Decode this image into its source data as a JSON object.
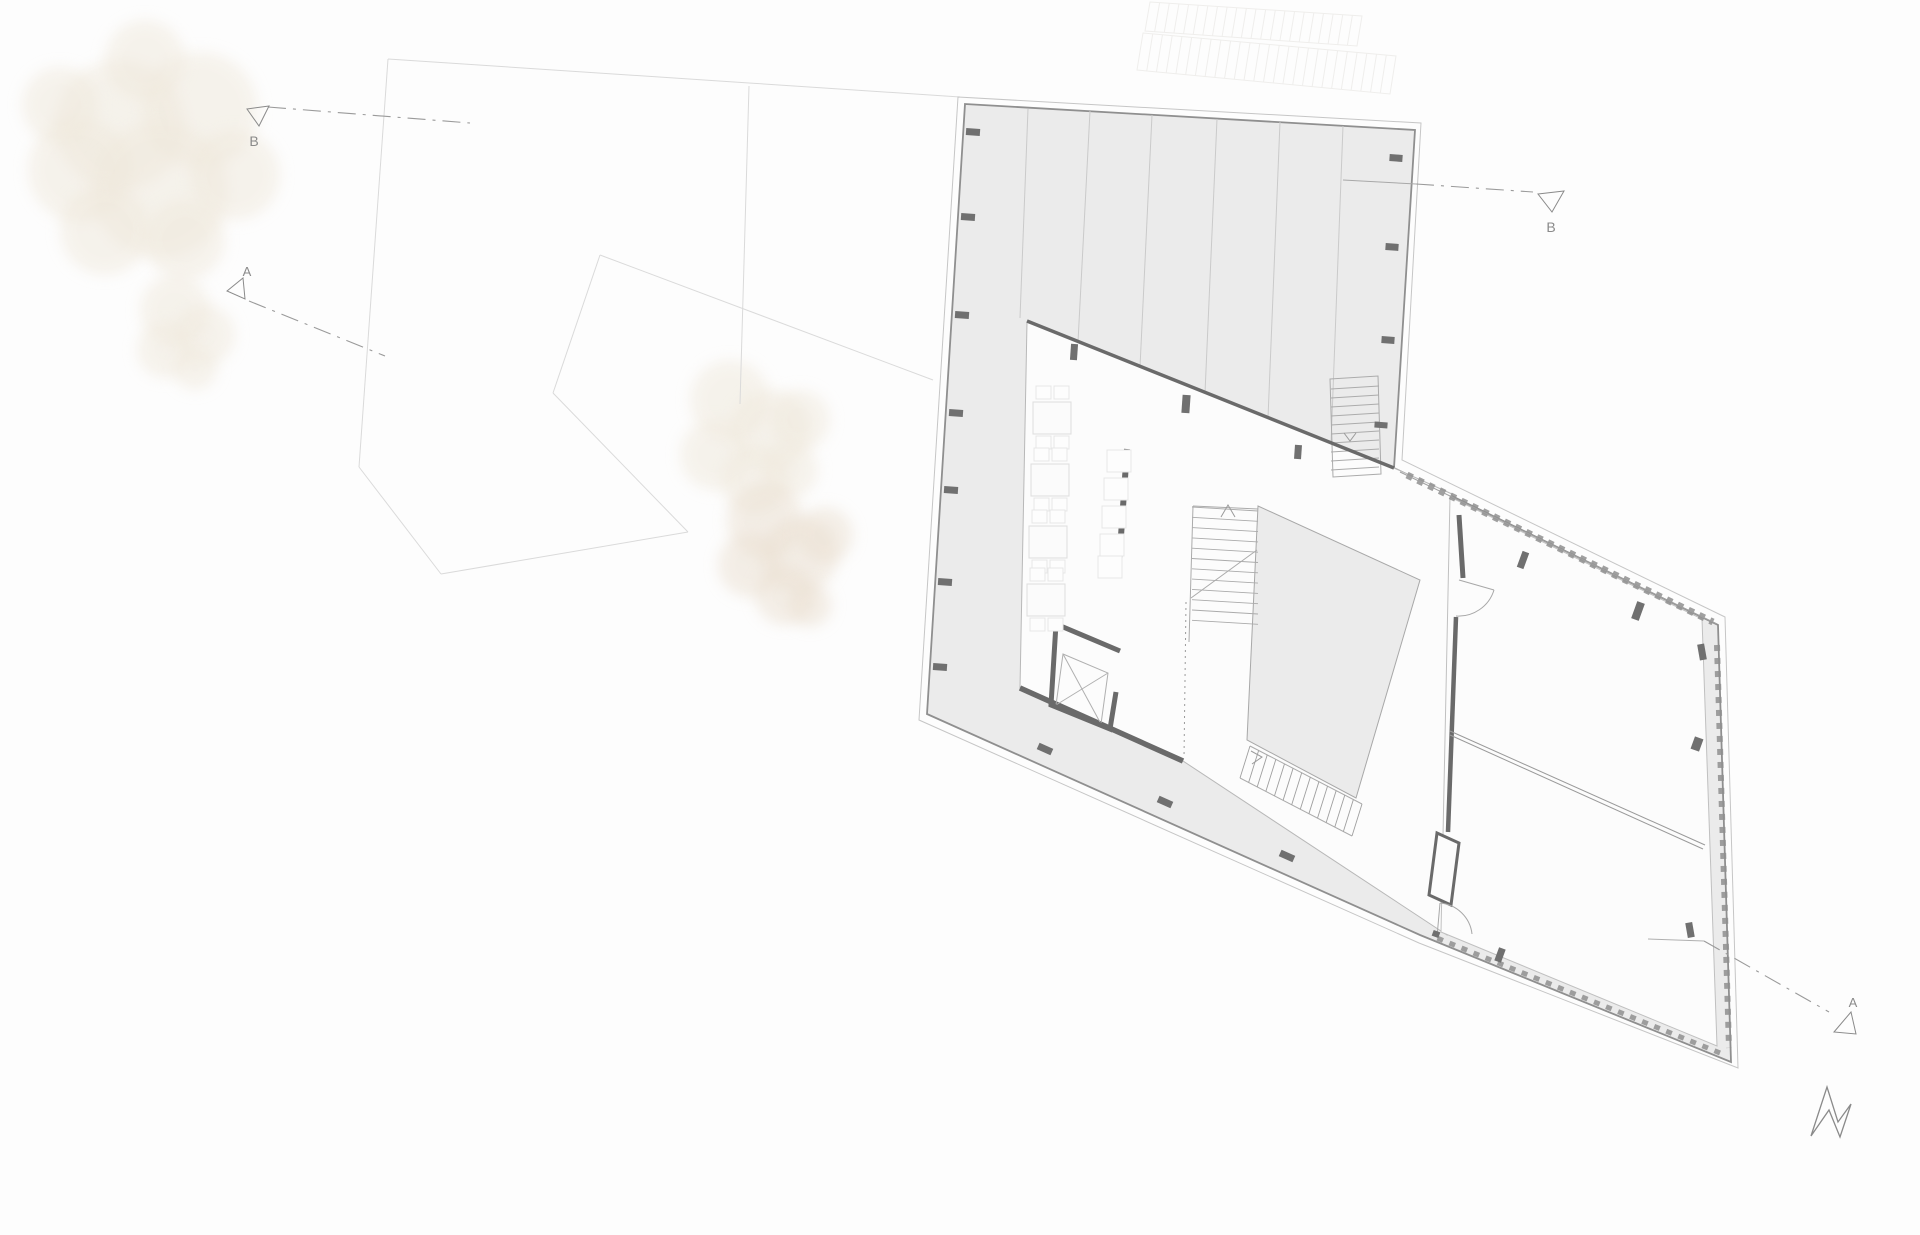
{
  "markers": {
    "b_left": {
      "label": "B"
    },
    "a_left": {
      "label": "A"
    },
    "b_right": {
      "label": "B"
    },
    "a_right": {
      "label": "A"
    }
  },
  "colors": {
    "background": "#fdfdfd",
    "deck_fill": "#ebebeb",
    "floor_fill": "#fcfcfc",
    "outline": "#8f8f8f",
    "outline_light": "#c6c6c6",
    "wall": "#6a6a6a",
    "column": "#707070",
    "thin_line": "#b8b8b8",
    "stair_line": "#ababab",
    "section_line": "#9a9a9a",
    "label": "#8a8a8a",
    "property_line": "#dadada",
    "neighbor_line": "#efeeec",
    "tree": "#efe8db",
    "tree_dark": "#eadfd0",
    "furniture_line": "#dedede"
  }
}
